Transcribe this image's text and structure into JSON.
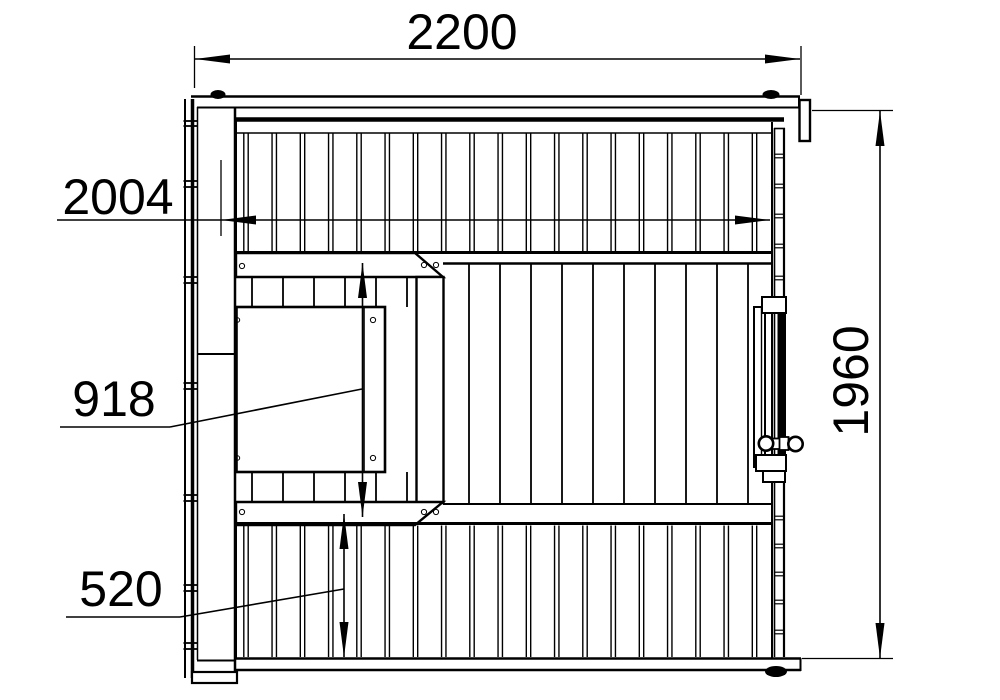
{
  "page": {
    "background": "#ffffff",
    "line_color": "#000000",
    "type": "technical-plan-drawing",
    "subject": "sauna cabin floor plan, top view"
  },
  "dimensions": {
    "overall_width": "2200",
    "inner_width": "2004",
    "overall_depth": "1960",
    "platform_depth": "918",
    "lower_bench_depth": "520"
  }
}
